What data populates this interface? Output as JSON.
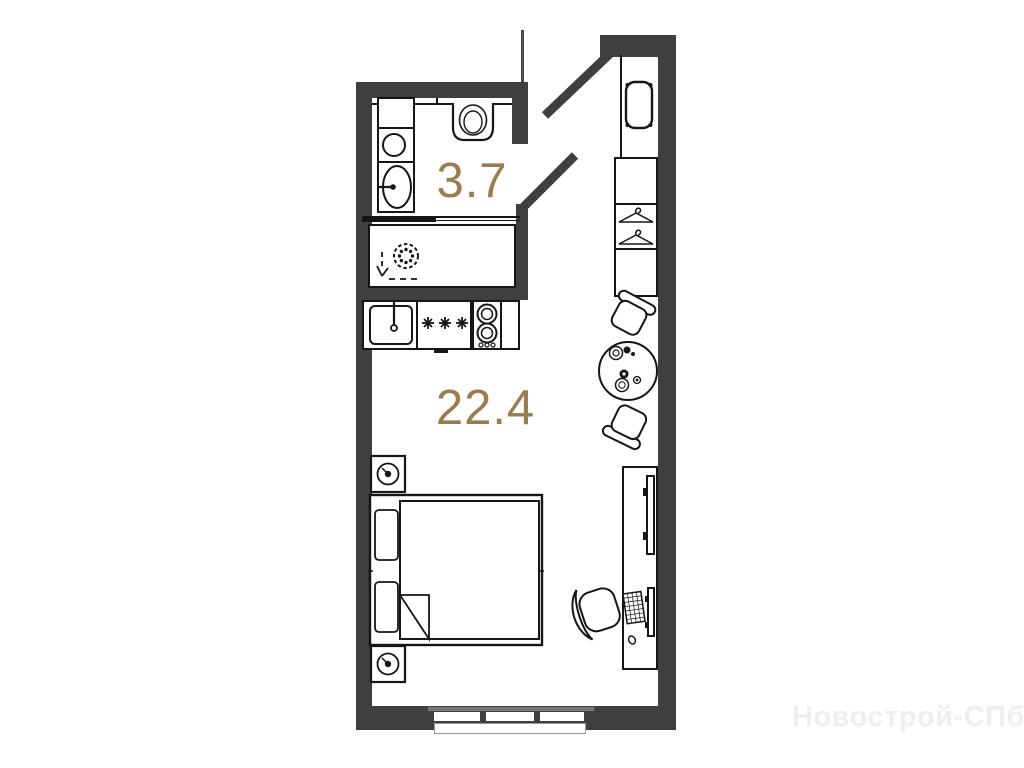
{
  "plan": {
    "bathroom_area": "3.7",
    "main_area": "22.4"
  },
  "watermark": {
    "text": "Новострой-СПб"
  },
  "colors": {
    "wall": "#3f3f3f",
    "line": "#161616",
    "accent": "#9b7c4d",
    "watermark": "#efeff0",
    "bg": "#ffffff"
  },
  "furniture_icons": {
    "bathroom": [
      "cabinet-icon",
      "washing-machine-icon",
      "bath-sink-icon",
      "toilet-icon",
      "shower-drain-icon",
      "slope-arrow-icon"
    ],
    "kitchen": [
      "kitchen-sink-icon",
      "hob-burners-icon",
      "stove-icon"
    ],
    "entry": [
      "stool-icon",
      "wardrobe-icon",
      "hanger-icon"
    ],
    "room": [
      "dining-table-icon",
      "chair-icon",
      "bed-icon",
      "nightstand-icon",
      "tv-icon",
      "computer-icon",
      "office-chair-icon"
    ],
    "window": "three-pane-window"
  }
}
